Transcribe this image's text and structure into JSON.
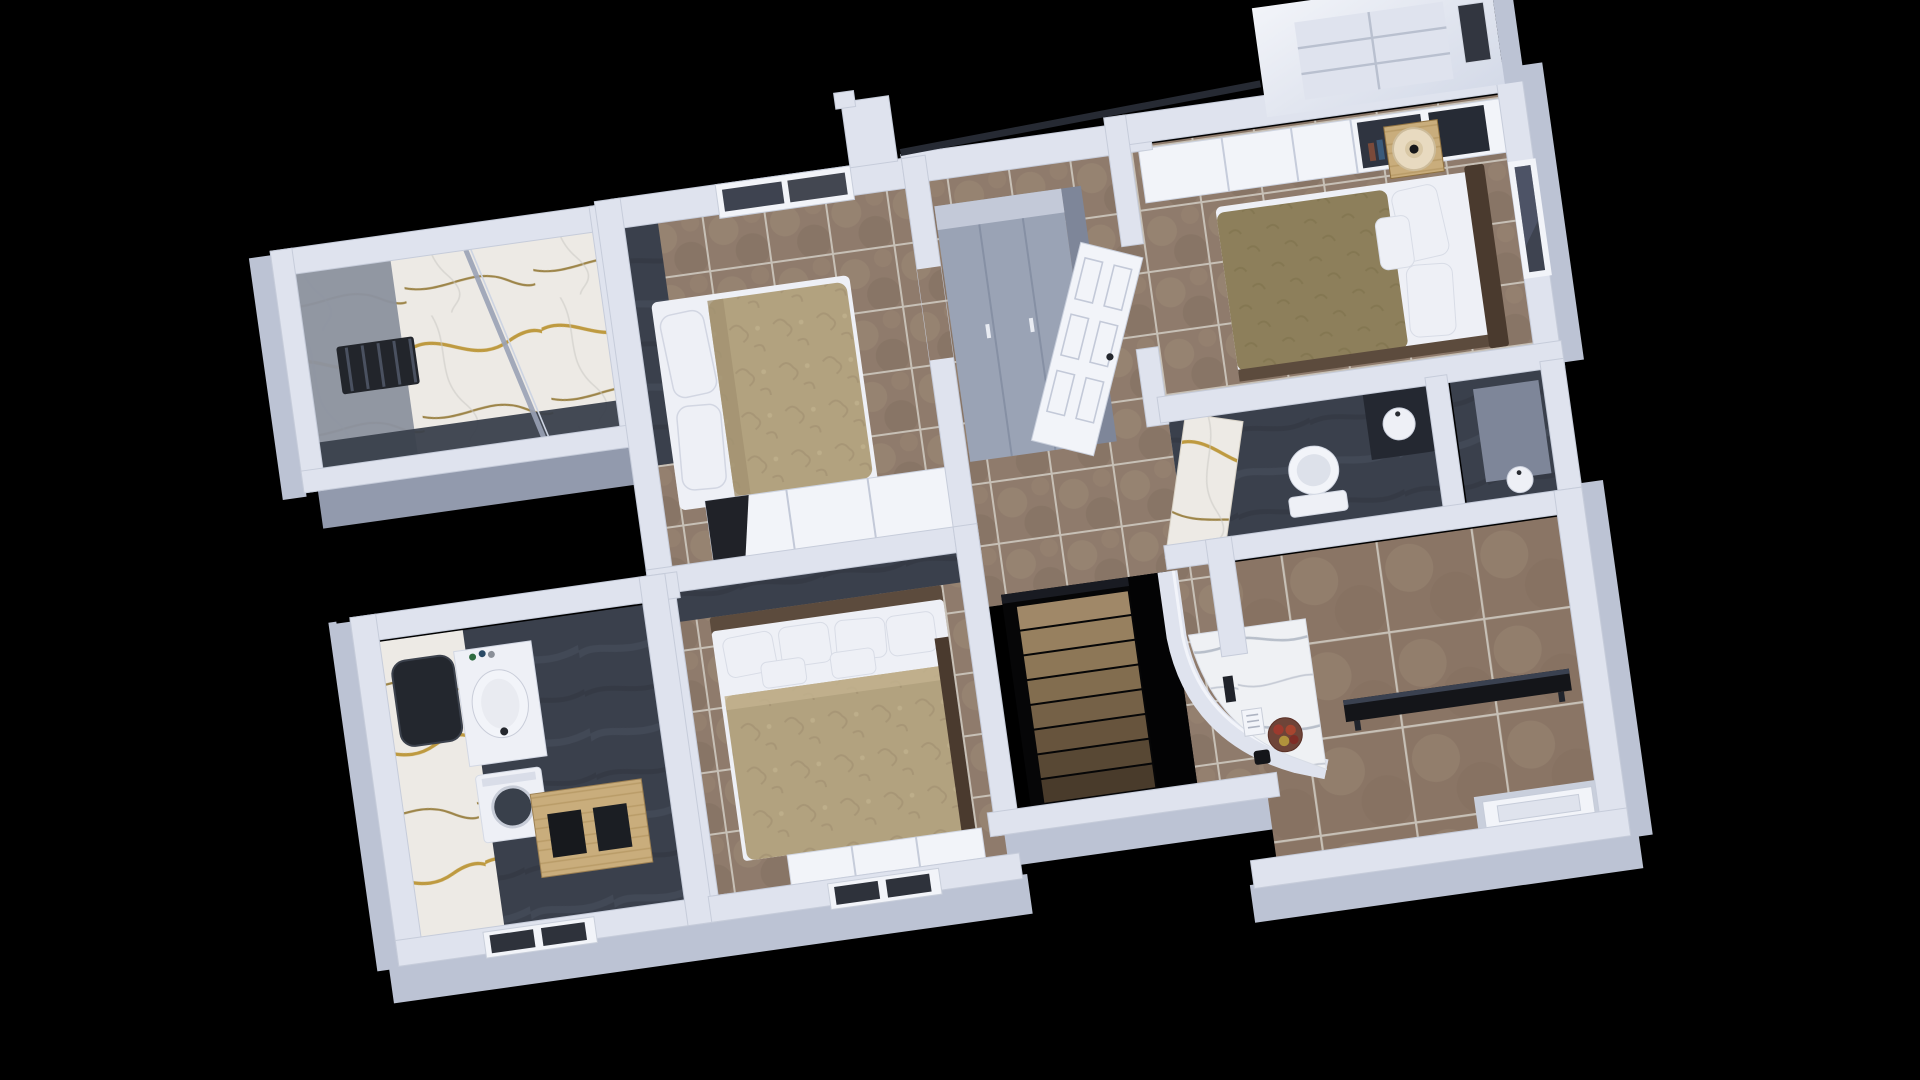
{
  "scene": {
    "title": "3D dollhouse floor-plan render of an upper storey on a black background",
    "view": "tilted top-down axonometric",
    "rooms": [
      {
        "id": "shower-room",
        "label": "marble shower room with radiator and glass screen"
      },
      {
        "id": "bedroom-north",
        "label": "bedroom with tan double bed and sliding wardrobe"
      },
      {
        "id": "hallway",
        "label": "hallway with grey wardrobe cabinet and open door"
      },
      {
        "id": "bedroom-east",
        "label": "bedroom with olive bed, gold nightstand and lamp"
      },
      {
        "id": "bathroom-east",
        "label": "dark bathroom with toilet and marble door"
      },
      {
        "id": "bathroom-west",
        "label": "bathroom with marble wall, mirror, sink, washer and oak cabinet"
      },
      {
        "id": "bedroom-south",
        "label": "bedroom with pillowed double bed and dresser"
      },
      {
        "id": "stair-hall",
        "label": "staircase descending with curved white parapet and marble desk"
      },
      {
        "id": "terrace-room",
        "label": "large tiled room with black bench and rear door"
      }
    ],
    "objects": [
      "bed",
      "pillows",
      "duvet",
      "nightstand",
      "table-lamp",
      "wardrobe",
      "toilet",
      "wash-basin",
      "mirror",
      "washing-machine",
      "oak-cabinet",
      "radiator",
      "glass-screen",
      "stairs",
      "fruit-bowl",
      "mug",
      "books",
      "bench",
      "door",
      "window",
      "chimney"
    ]
  },
  "colors": {
    "background": "#000000",
    "wall": "#dfe3ee",
    "wallBright": "#f2f4f9",
    "wallShade": "#bcc3d4",
    "wallDark": "#9aa2b6",
    "wallStroke": "#c6ccda",
    "floorTile": "#8f7b6c",
    "floorTileLight": "#9a8773",
    "floorTileDark": "#837060",
    "grout": "#c7c0b6",
    "bigTile": "#8a7565",
    "slate": "#3a404c",
    "slateVein": "#4a515f",
    "slateDark": "#2e333d",
    "marble": "#edeae5",
    "marbleVein": "#b9912f",
    "marbleVeinDark": "#8a6b22",
    "marbleGray": "#eff1f4",
    "marbleGrayVein": "#aab3bf",
    "duvetTan": "#b2a27f",
    "duvetTanDeep": "#a39272",
    "duvetOlive": "#8d7f5b",
    "duvetOliveDeep": "#81744f",
    "pillow": "#eef0f6",
    "pillowEdge": "#d5dae5",
    "headboard": "#4a3a2e",
    "bedRail": "#5c4b3d",
    "wood": "#c9ad7c",
    "woodGrain": "#b3945f",
    "gold": "#b89255",
    "stairCarpet": "#97805f",
    "glass": "#3e4350",
    "glassSheen": "#596178",
    "cabinetGray": "#9aa3b5",
    "cabinetGraySide": "#7e8699",
    "cabinetGrayTop": "#c3c9d8",
    "lampShade": "#e8dac0",
    "lampBase": "#17181a",
    "appleRed": "#9c3a2e",
    "appleGold": "#b0923c",
    "benchBlack": "#141519",
    "mirrorGlass": "#23272e",
    "stoneGray": "#8d939f",
    "voidBlack": "#060607",
    "radiator": "#22252b"
  }
}
